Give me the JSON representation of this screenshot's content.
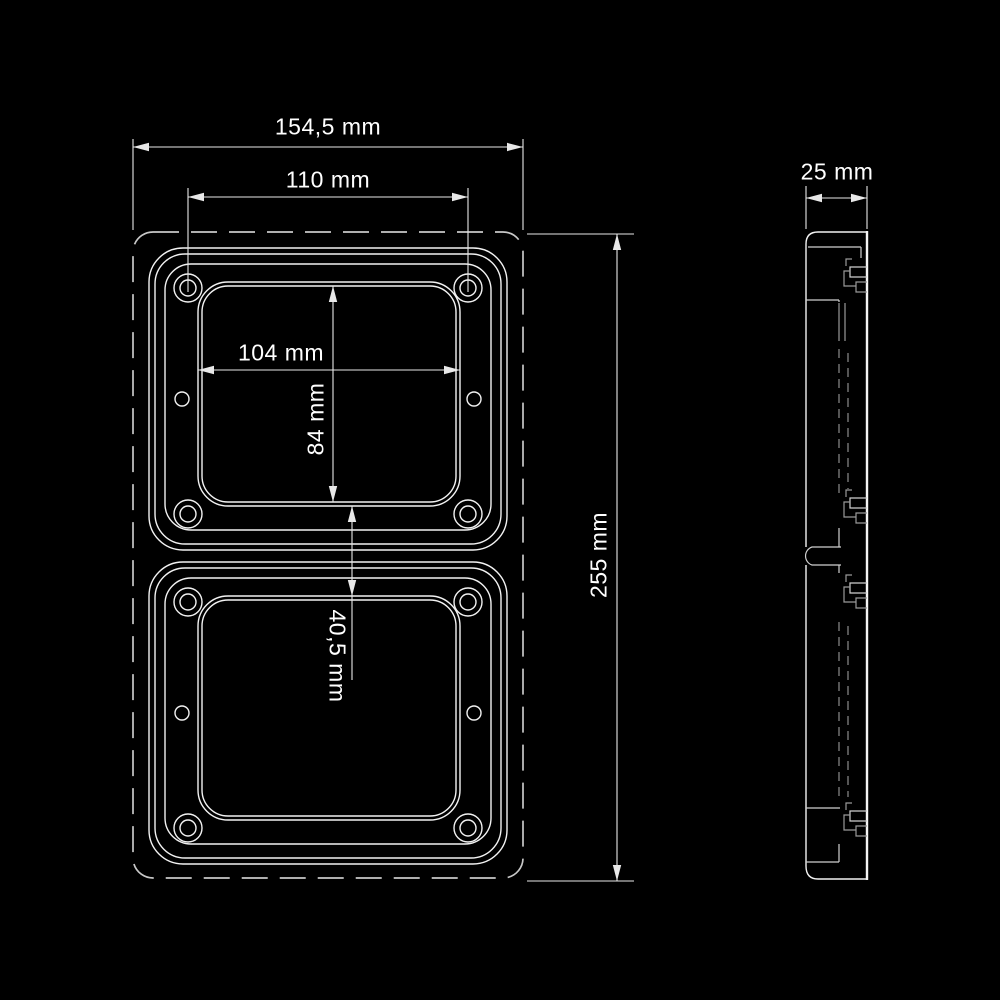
{
  "drawing": {
    "type": "technical-dimension-drawing",
    "dimensions": {
      "overall_width": "154,5 mm",
      "mounting_hole_spacing": "110 mm",
      "opening_width": "104 mm",
      "opening_height": "84 mm",
      "opening_gap": "40,5 mm",
      "overall_height": "255 mm",
      "depth": "25 mm"
    },
    "colors": {
      "background": "#000000",
      "outline": "#f2f2f2",
      "hidden_dashed_outline": "#c8c8c8",
      "dimension_line": "#e8e8e8",
      "text": "#ffffff"
    }
  }
}
